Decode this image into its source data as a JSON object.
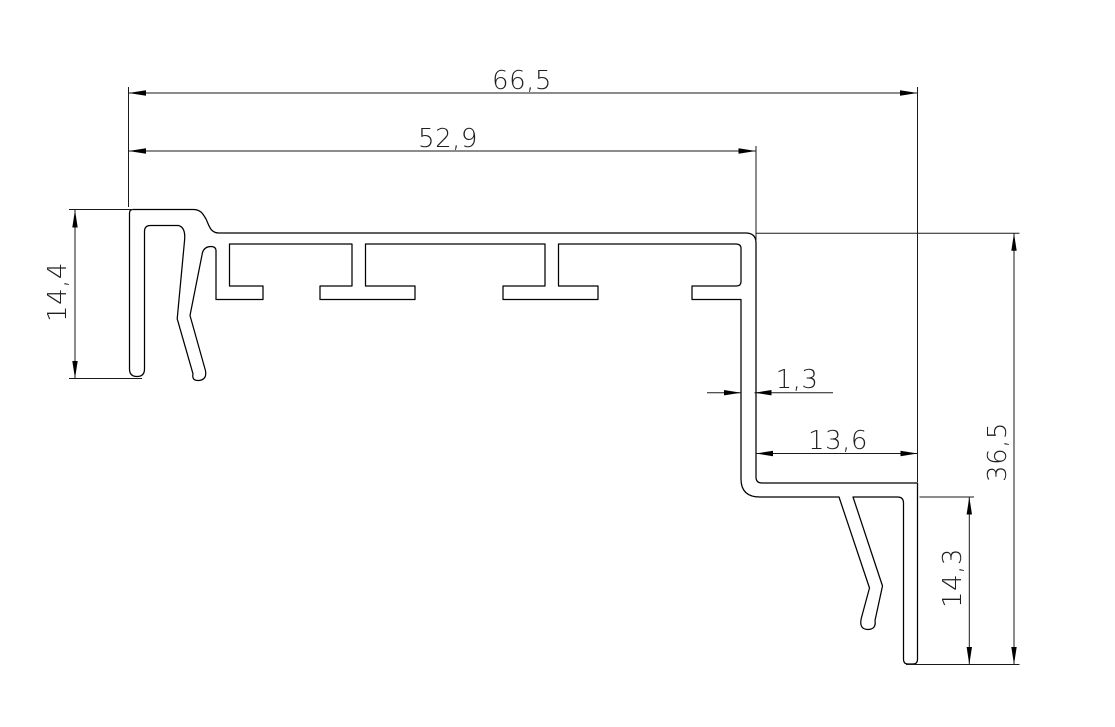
{
  "canvas": {
    "width": 1115,
    "height": 727,
    "background": "#ffffff",
    "line_color": "#000000",
    "dimension_line_color": "#1a1a1a",
    "text_color": "#1f1f1f"
  },
  "profile": {
    "description": "extruded-profile-cross-section",
    "path": "M 133,209.5 L 193,209.5 C 201,209.5 203,214 206,219 C 209,225 210,233 219,233 L 746.5,233 Q 756,233.5 756,243 L 756,477 Q 756,483 762,483 L 917.5,483 L 917.5,659.5 Q 917.5,664 913,664 L 908,664 Q 903.5,664 903.5,659.5 L 903.5,503 Q 903.5,497 897.5,497 L 853,497 L 882.5,586 L 875,620.5 Q 876.5,629.5 867.5,629.5 Q 858.5,629 861.5,617.5 L 869.5,588 L 839,497 L 760,497 Q 741,497 741,479 L 741,299.5 L 692,299.5 L 692,286 L 736.5,286 Q 741,286 741,281.5 L 741,248.5 Q 741,244 736,244 L 558.5,244 L 558.5,286 L 598,286 L 598,299.5 L 503,299.5 L 503,286 L 545,286 L 545,244 L 365.5,244 L 365.5,286 L 415,286 L 415,299.5 L 320,299.5 L 320,286 L 352,286 L 352,244 L 229.5,244 L 229.5,286 L 263,286 L 263,299.5 L 216,299.5 L 216,251 Q 216,246.5 211,246.5 Q 204.5,246.5 202.5,252.5 L 190,315.5 L 205.3,370 Q 207.5,379.5 199,380.5 Q 191.5,381 193,373.8 L 177.2,318.8 L 184.5,241 Q 186,227.5 178.5,225.5 L 150.5,225.5 Q 144.5,225.5 144.5,231.5 L 144.5,369 Q 144.5,376.5 137,376.5 Q 129.5,376.5 129.5,369 L 129.5,213 Q 129.5,209.5 133,209.5 Z"
  },
  "dimensions": {
    "overall_width": {
      "label": "66,5",
      "value_mm": 66.5,
      "orientation": "horizontal"
    },
    "body_width": {
      "label": "52,9",
      "value_mm": 52.9,
      "orientation": "horizontal"
    },
    "left_end_height": {
      "label": "14,4",
      "value_mm": 14.4,
      "orientation": "vertical"
    },
    "wall_thickness": {
      "label": "1,3",
      "value_mm": 1.3,
      "orientation": "horizontal"
    },
    "offset_width": {
      "label": "13,6",
      "value_mm": 13.6,
      "orientation": "horizontal"
    },
    "overall_height": {
      "label": "36,5",
      "value_mm": 36.5,
      "orientation": "vertical"
    },
    "leg_height": {
      "label": "14,3",
      "value_mm": 14.3,
      "orientation": "vertical"
    }
  }
}
